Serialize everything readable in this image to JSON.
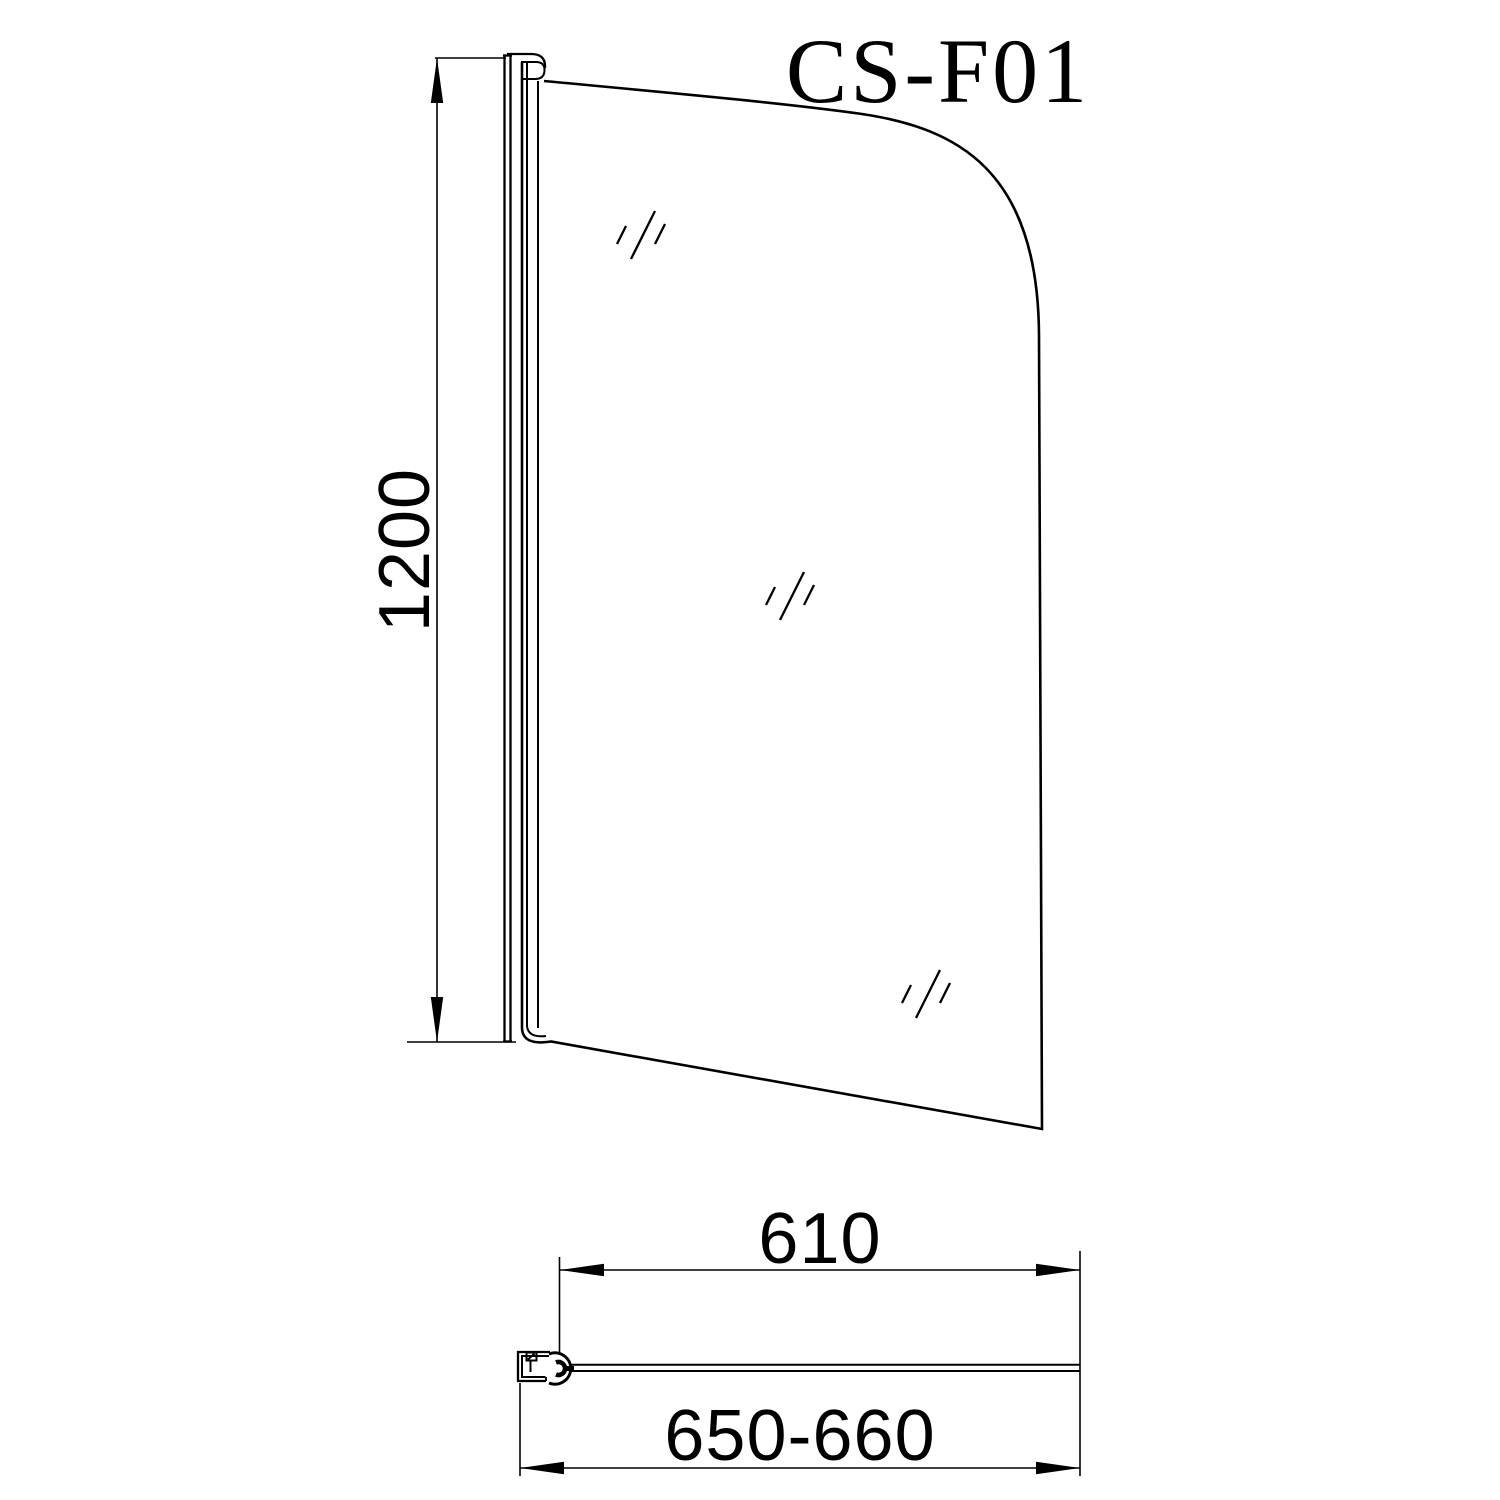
{
  "drawing": {
    "model_label": "CS-F01",
    "background_color": "#ffffff",
    "line_color": "#000000",
    "front_view": {
      "height_dimension_label": "1200"
    },
    "plan_view": {
      "glass_width_dimension_label": "610",
      "overall_width_dimension_label": "650-660"
    }
  }
}
